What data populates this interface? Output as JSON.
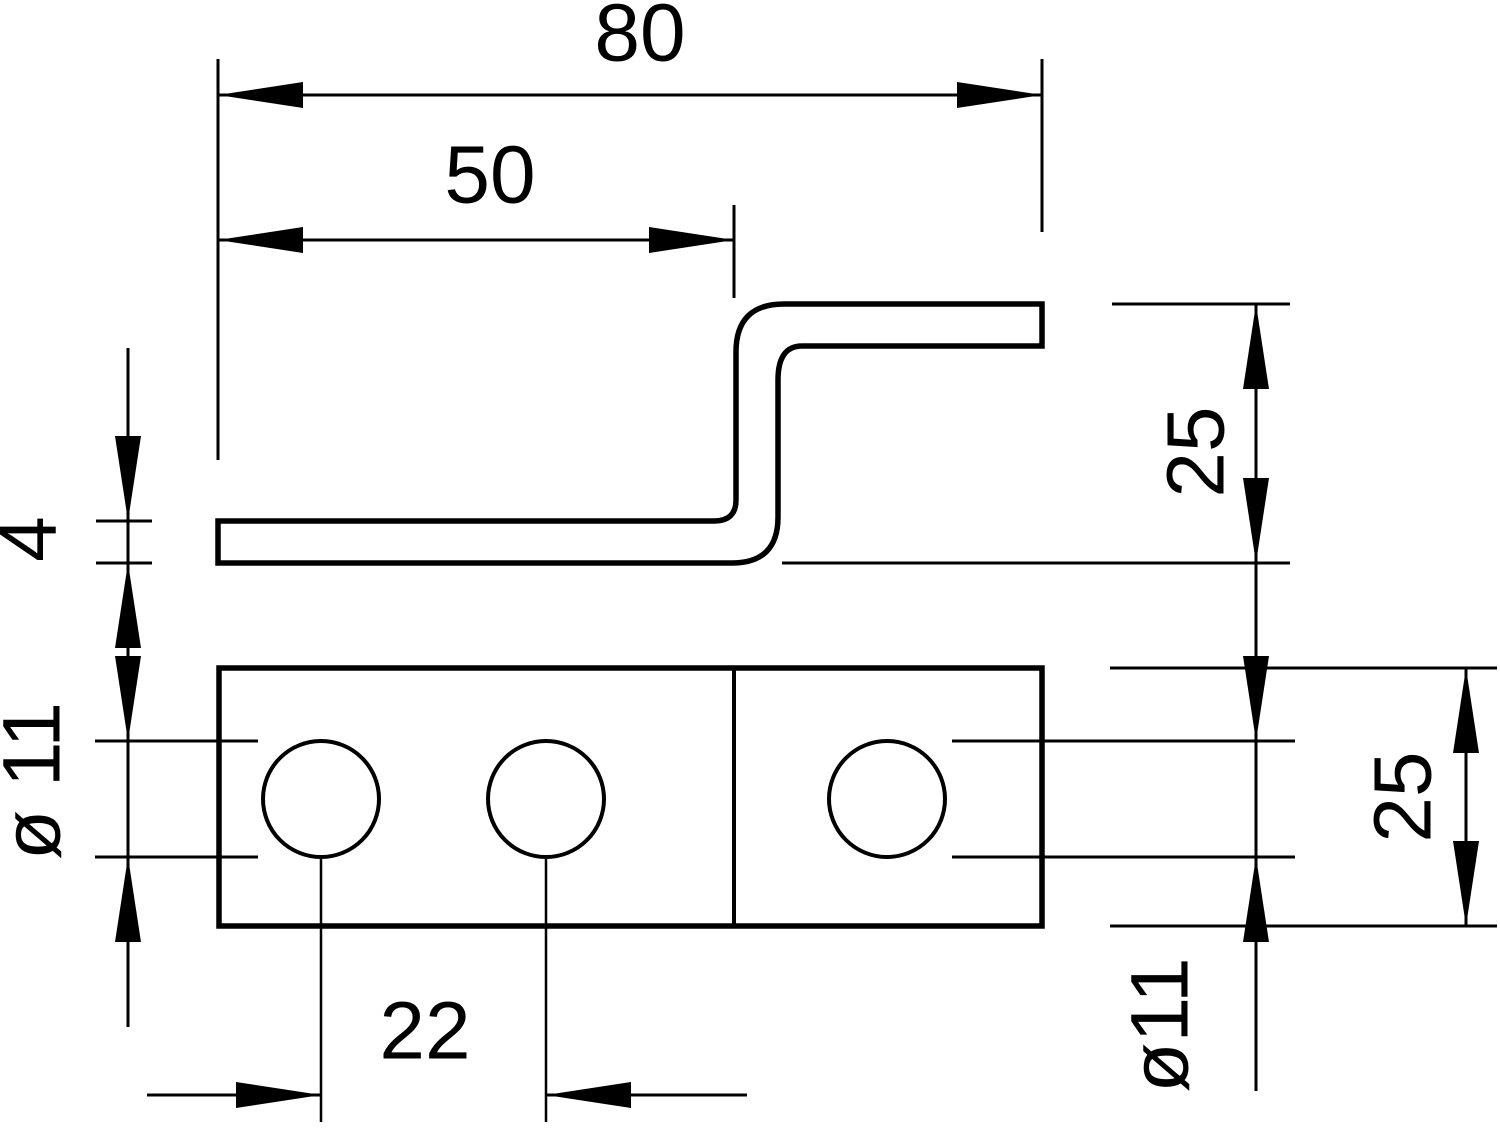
{
  "drawing": {
    "colors": {
      "line": "#000000",
      "background": "#ffffff"
    },
    "side_view": {
      "overall_length": "80",
      "lower_flange_length": "50",
      "profile_height": "25",
      "material_thickness": "4"
    },
    "plan_view": {
      "hole_diameter_left": "ø 11",
      "hole_spacing": "22",
      "hole_diameter_right": "ø11",
      "plate_width": "25"
    }
  }
}
